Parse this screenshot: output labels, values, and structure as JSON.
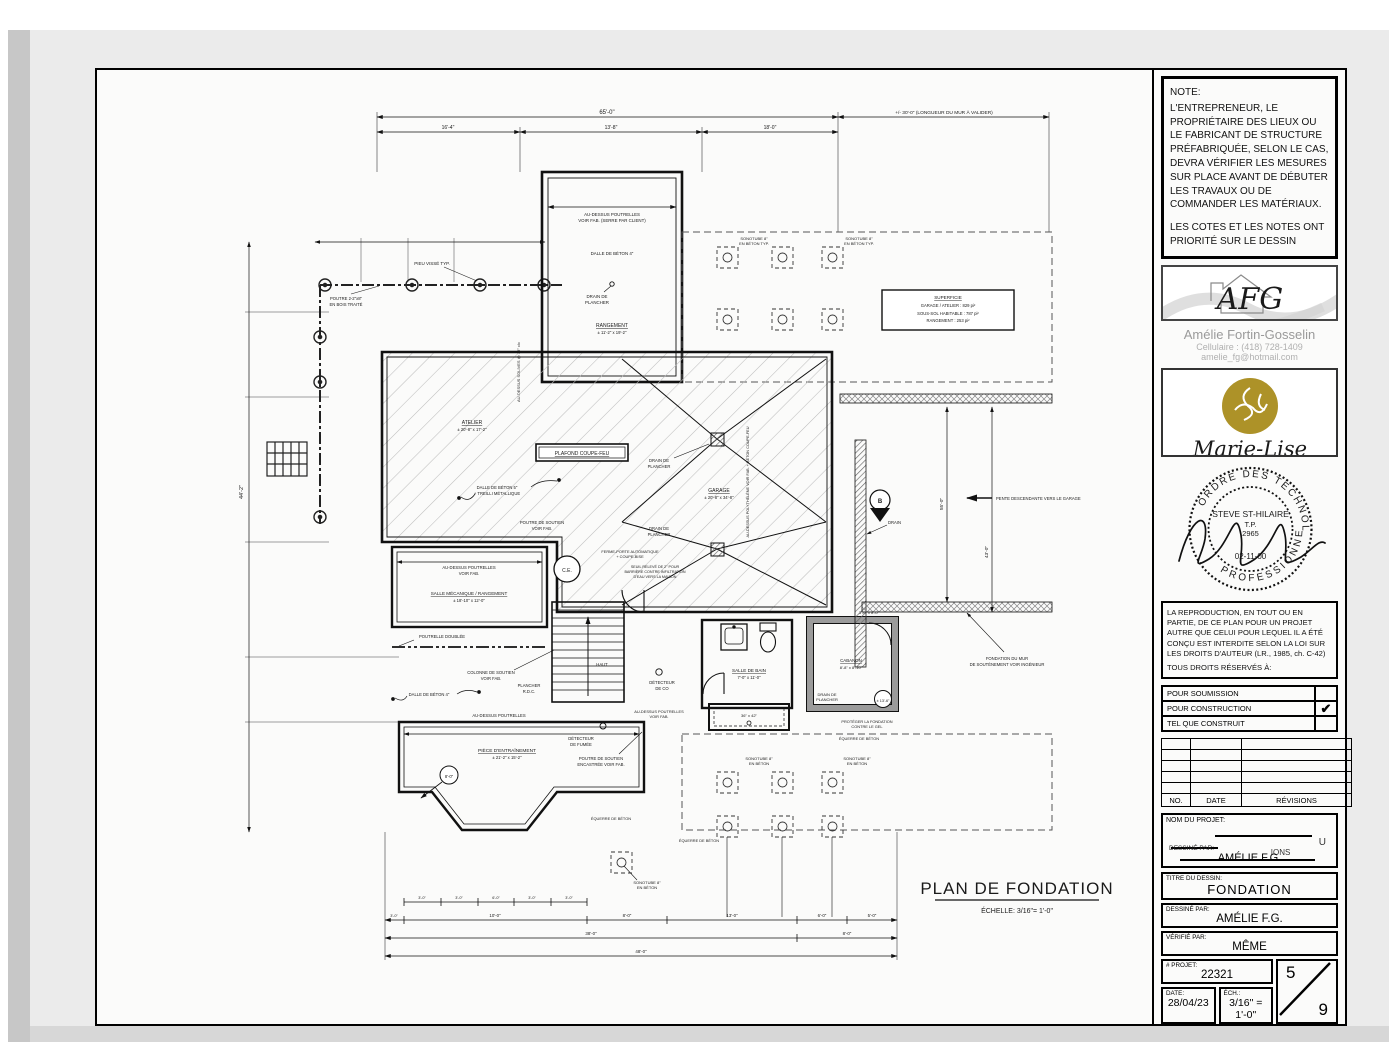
{
  "sheet": {
    "note": {
      "title": "NOTE:",
      "body": "L'ENTREPRENEUR, LE PROPRIÉTAIRE DES LIEUX OU LE FABRICANT DE STRUCTURE PRÉFABRIQUÉE, SELON LE CAS, DEVRA VÉRIFIER LES MESURES SUR PLACE AVANT DE DÉBUTER LES TRAVAUX OU DE COMMANDER LES MATÉRIAUX.",
      "body2": "LES COTES ET LES NOTES ONT PRIORITÉ SUR LE DESSIN"
    },
    "afg": {
      "initials": "AFG",
      "tagline": "dessinatrice en bâtiment",
      "name": "Amélie Fortin-Gosselin",
      "phone": "Cellulaire : (418) 728-1409",
      "email": "amelie_fg@hotmail.com",
      "green": "#7a8c53"
    },
    "marielise": {
      "name": "Marie-Lise",
      "tagline": "antiquité design",
      "gold": "#ad9228"
    },
    "stamp": {
      "arc_top": "ORDRE  DES  TECHNOLOGUES",
      "arc_bottom": "PROFESSIONNELS",
      "name": "STEVE ST-HILAIRE",
      "title": "T.P.",
      "number": "2965",
      "date": "02-11-00"
    },
    "copyright": {
      "body": "LA REPRODUCTION, EN TOUT OU EN PARTIE, DE CE PLAN POUR UN PROJET AUTRE QUE CELUI POUR LEQUEL IL A ÉTÉ CONÇU EST INTERDITE SELON LA LOI SUR LES DROITS D'AUTEUR (LR., 1985, ch. C-42)",
      "footer": "TOUS DROITS RÉSERVÉS À:"
    },
    "checkboxes": [
      {
        "label": "POUR SOUMISSION",
        "mark": ""
      },
      {
        "label": "POUR CONSTRUCTION",
        "mark": "✔"
      },
      {
        "label": "TEL QUE CONSTRUIT",
        "mark": ""
      }
    ],
    "revisions": {
      "headers": [
        "NO.",
        "DATE",
        "RÉVISIONS"
      ]
    },
    "project": {
      "nom_label": "NOM DU PROJET:",
      "frag1": "U",
      "frag2": "IONS",
      "dessine_label": "DESSINÉ PAR:",
      "dessine": "AMÉLIE F.G."
    },
    "titleblock": {
      "titre_label": "TITRE DU DESSIN:",
      "titre": "FONDATION",
      "dessine_label": "DESSINÉ PAR:",
      "dessine": "AMÉLIE F.G.",
      "verifie_label": "VÉRIFIÉ PAR:",
      "verifie": "MÊME",
      "projet_label": "# PROJET:",
      "projet": "22321",
      "date_label": "DATE:",
      "date": "28/04/23",
      "ech_label": "ÉCH.:",
      "ech": "3/16\" = 1'-0\"",
      "sheet_no": "5",
      "sheet_total": "9"
    }
  },
  "plan": {
    "title": "PLAN DE FONDATION",
    "scale": "ÉCHELLE:  3/16\"= 1'-0\"",
    "labels": {
      "audc1": "AU-DESSUS POUTRELLES",
      "audc2": "VOIR FAB. (SERRE PAR CLIENT)",
      "dalle4": "DALLE DE BÉTON 4\"",
      "dalle5a": "DALLE DE BÉTON 5\"",
      "dalle5b": "+ TREILLI MÉTALLIQUE",
      "draina": "DRAIN DE",
      "drainb": "PLANCHER",
      "rang": "RANGEMENT",
      "rangsz": "± 11'-2\" x 19'-2\"",
      "atel": "ATELIER",
      "atelsz": "± 20'-8\" x 17'-2\"",
      "gar": "GARAGE",
      "garsz": "± 20'-8\" x 34'-8\"",
      "pcf": "PLAFOND COUPE-FEU",
      "supt": "SUPERFICIE",
      "sup1": "GARAGE / ATELIER : 829 pi²",
      "sup2": "SOUS-SOL HABITABLE : 787 pi²",
      "sup3": "RANGEMENT : 253 pi²",
      "sono1": "SONOTUBE 8\"",
      "sono2": "EN BÉTON",
      "sono2t": "EN BÉTON TYP.",
      "pieu": "PIEU VISSÉ TYP.",
      "poutb1": "POUTRE 2-2\"x8\"",
      "poutb2": "EN BOIS TRAITÉ",
      "solives": "AU-DESSUS SOLIVES @ 16\" c/c",
      "poly": "AU-DESSUS POLYTHÉLÈNE VOIR FAB. + BÉTON COUPE-FEU",
      "aud1": "AU-DESSUS POUTRELLES",
      "aud2": "VOIR FAB.",
      "smec": "SALLE MÉCANIQUE / RANGEMENT",
      "smecsz": "± 18'-10\" x 12'-0\"",
      "poutd": "POUTRELLE DOUBLÉE",
      "col1": "COLONNE DE SOUTIEN",
      "col2": "VOIR FAB.",
      "rdc1": "PLANCHER",
      "rdc2": "R.D.C.",
      "haut": "HAUT",
      "co1": "DÉTECTEUR",
      "co2": "DE CO",
      "fum1": "DÉTECTEUR",
      "fum2": "DE FUMÉE",
      "ps1": "POUTRE DE SOUTIEN",
      "ps2": "VOIR FAB.",
      "pse1": "POUTRE DE SOUTIEN",
      "pse2": "ENCASTRÉE VOIR FAB.",
      "piece": "PIÈCE D'ENTRAÎNEMENT",
      "piecesz": "± 21'-2\" x 15'-2\"",
      "sdb": "SALLE DE BAIN",
      "sdbsz": "7'-0\" x 11'-0\"",
      "shower": "36\" x 42\"",
      "cab": "CABANON",
      "cabsz": "8'-8\" x 8'-10\"",
      "cabdim": "3'-6\" x 8'-0\"",
      "drain": "DRAIN",
      "pente": "PENTE DESCENDANTE VERS LE GARAGE",
      "fond1": "FONDATION DU MUR",
      "fond2": "DE SOUTÈNEMENT VOIR INGÉNIEUR",
      "equerre": "ÉQUERRE DE BÉTON",
      "prot1": "PROTÉGER LA FONDATION",
      "prot2": "CONTRE LE GEL",
      "ferme1": "FERME-PORTE AUTOMATIQUE",
      "ferme2": "+ COUPE-BISE",
      "seuil1": "SEUIL RELEVÉ DE 2\" POUR",
      "seuil2": "BARRIÈRE CONTRE INFILTRATION",
      "seuil3": "D'EAU VERS LA MAISON",
      "ce": "C.E.",
      "b": "B",
      "h8": "8'-0\"",
      "h13": "± 13'-6\""
    },
    "dims": {
      "topo": "65'-0\"",
      "topm": "+/- 30'-0\" (LONGUEUR DU MUR À VALIDER)",
      "t1": "16'-4\"",
      "t2": "13'-8\"",
      "t3": "18'-0\"",
      "sm": [
        "3'-0\"",
        "3'-0\"",
        "6'-0\"",
        "3'-0\"",
        "3'-0\""
      ],
      "b3": "3'-0\"",
      "b10": "10'-0\"",
      "b8": "8'-0\"",
      "b13": "13'-0\"",
      "b6": "6'-0\"",
      "b5": "5'-0\"",
      "b38": "38'-0\"",
      "b8b": "8'-0\"",
      "b48": "48'-0\"",
      "l44": "44'-2\"",
      "r55": "55'-0\"",
      "r43": "43'-0\""
    }
  }
}
